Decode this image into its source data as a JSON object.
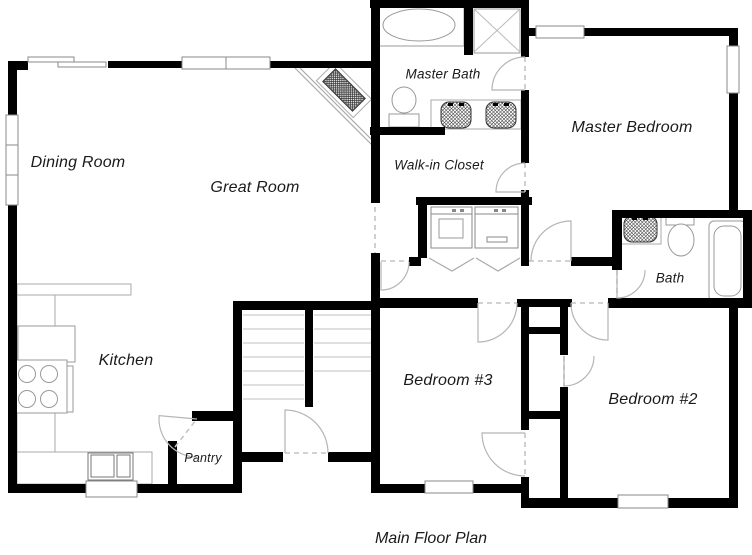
{
  "caption": "Main Floor Plan",
  "rooms": [
    {
      "label": "Dining Room",
      "x": 78,
      "y": 163,
      "size": 16
    },
    {
      "label": "Great Room",
      "x": 255,
      "y": 188,
      "size": 16
    },
    {
      "label": "Master Bath",
      "x": 443,
      "y": 74,
      "size": 13.5
    },
    {
      "label": "Walk-in Closet",
      "x": 439,
      "y": 165,
      "size": 13.5
    },
    {
      "label": "Master Bedroom",
      "x": 632,
      "y": 128,
      "size": 16
    },
    {
      "label": "Bath",
      "x": 670,
      "y": 278,
      "size": 13.5
    },
    {
      "label": "Kitchen",
      "x": 126,
      "y": 361,
      "size": 16
    },
    {
      "label": "Pantry",
      "x": 203,
      "y": 458,
      "size": 12.5
    },
    {
      "label": "Bedroom #3",
      "x": 448,
      "y": 381,
      "size": 16
    },
    {
      "label": "Bedroom #2",
      "x": 653,
      "y": 400,
      "size": 16
    }
  ],
  "caption_pos": {
    "x": 431,
    "y": 539
  },
  "colors": {
    "background": "#ffffff",
    "wall": "#000000",
    "fixture": "#999999",
    "fixture_dark": "#666666",
    "door": "#b5b5b5",
    "dash": "#c4c4c4",
    "tread": "#cccccc",
    "window_stroke": "#8a8a8a",
    "hatch": "#444444",
    "text": "#1a1a1a"
  }
}
